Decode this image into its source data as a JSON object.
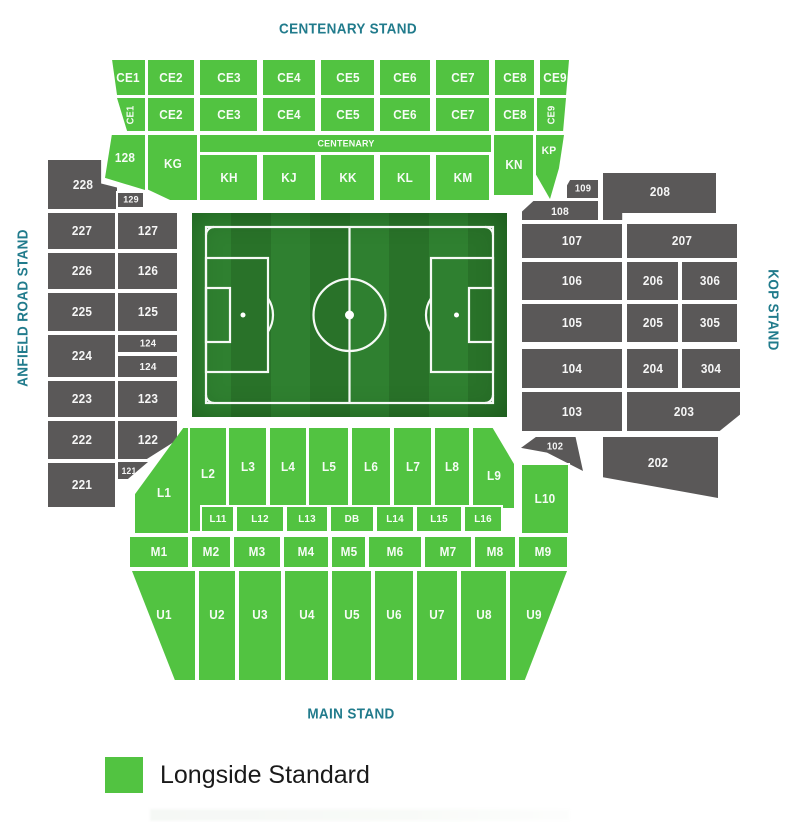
{
  "stands": {
    "centenary": "CENTENARY STAND",
    "anfield_road": "ANFIELD ROAD STAND",
    "kop": "KOP STAND",
    "main": "MAIN STAND"
  },
  "legend": {
    "items": [
      {
        "label": "Longside Standard",
        "color": "#52c341",
        "category": "available"
      }
    ]
  },
  "colors": {
    "available": "#52c341",
    "unavailable": "#5a5858",
    "title": "#217b8c",
    "legend_text": "#1a1a1a",
    "pitch_stripe_light": "#2f8030",
    "pitch_stripe_dark": "#297229",
    "pitch_line": "#ffffff"
  },
  "sections": [
    {
      "id": "ce1a",
      "label": "CE1",
      "t": "a",
      "r": [
        110,
        60,
        35,
        35
      ],
      "clip": "polygon(6% 0,100% 0,100% 100%,20% 100%)"
    },
    {
      "id": "ce2a",
      "label": "CE2",
      "t": "a",
      "r": [
        148,
        60,
        46,
        35
      ]
    },
    {
      "id": "ce3a",
      "label": "CE3",
      "t": "a",
      "r": [
        200,
        60,
        57,
        35
      ]
    },
    {
      "id": "ce4a",
      "label": "CE4",
      "t": "a",
      "r": [
        263,
        60,
        52,
        35
      ]
    },
    {
      "id": "ce5a",
      "label": "CE5",
      "t": "a",
      "r": [
        321,
        60,
        53,
        35
      ]
    },
    {
      "id": "ce6a",
      "label": "CE6",
      "t": "a",
      "r": [
        380,
        60,
        50,
        35
      ]
    },
    {
      "id": "ce7a",
      "label": "CE7",
      "t": "a",
      "r": [
        436,
        60,
        53,
        35
      ]
    },
    {
      "id": "ce8a",
      "label": "CE8",
      "t": "a",
      "r": [
        495,
        60,
        39,
        35
      ]
    },
    {
      "id": "ce9a",
      "label": "CE9",
      "t": "a",
      "r": [
        540,
        60,
        29,
        35
      ],
      "clip": "polygon(0 0,100% 0,90% 100%,0 100%)"
    },
    {
      "id": "ce1b",
      "label": "CE1",
      "t": "a",
      "r": [
        117,
        98,
        28,
        33
      ],
      "clip": "polygon(0 0,100% 0,100% 100%,36% 100%)",
      "rot": -90,
      "fs": 10
    },
    {
      "id": "ce2b",
      "label": "CE2",
      "t": "a",
      "r": [
        148,
        98,
        46,
        33
      ]
    },
    {
      "id": "ce3b",
      "label": "CE3",
      "t": "a",
      "r": [
        200,
        98,
        57,
        33
      ]
    },
    {
      "id": "ce4b",
      "label": "CE4",
      "t": "a",
      "r": [
        263,
        98,
        52,
        33
      ]
    },
    {
      "id": "ce5b",
      "label": "CE5",
      "t": "a",
      "r": [
        321,
        98,
        53,
        33
      ]
    },
    {
      "id": "ce6b",
      "label": "CE6",
      "t": "a",
      "r": [
        380,
        98,
        50,
        33
      ]
    },
    {
      "id": "ce7b",
      "label": "CE7",
      "t": "a",
      "r": [
        436,
        98,
        53,
        33
      ]
    },
    {
      "id": "ce8b",
      "label": "CE8",
      "t": "a",
      "r": [
        495,
        98,
        39,
        33
      ]
    },
    {
      "id": "ce9b",
      "label": "CE9",
      "t": "a",
      "r": [
        537,
        98,
        29,
        33
      ],
      "clip": "polygon(0 0,100% 0,90% 100%,0 100%)",
      "rot": -90,
      "fs": 10
    },
    {
      "id": "s128",
      "label": "128",
      "t": "a",
      "r": [
        105,
        135,
        40,
        55
      ],
      "clip": "polygon(17% 0,100% 0,100% 100%,0 78%)",
      "ly": 42
    },
    {
      "id": "kg",
      "label": "KG",
      "t": "a",
      "r": [
        148,
        135,
        49,
        65
      ],
      "clip": "polygon(0 0,100% 0,100% 100%,45% 100%,0 84%)",
      "ly": 45
    },
    {
      "id": "cstrip",
      "label": "CENTENARY",
      "t": "a",
      "r": [
        200,
        135,
        291,
        17
      ],
      "fs": 9.5
    },
    {
      "id": "kh",
      "label": "KH",
      "t": "a",
      "r": [
        200,
        155,
        57,
        45
      ]
    },
    {
      "id": "kj",
      "label": "KJ",
      "t": "a",
      "r": [
        263,
        155,
        52,
        45
      ]
    },
    {
      "id": "kk",
      "label": "KK",
      "t": "a",
      "r": [
        321,
        155,
        53,
        45
      ]
    },
    {
      "id": "kl",
      "label": "KL",
      "t": "a",
      "r": [
        380,
        155,
        50,
        45
      ]
    },
    {
      "id": "km",
      "label": "KM",
      "t": "a",
      "r": [
        436,
        155,
        53,
        45
      ]
    },
    {
      "id": "kn",
      "label": "KN",
      "t": "a",
      "r": [
        494,
        135,
        39,
        60
      ]
    },
    {
      "id": "kp",
      "label": "KP",
      "t": "a",
      "r": [
        536,
        135,
        28,
        64
      ],
      "clip": "polygon(0 0,100% 0,82% 52%,50% 100%,0 62%)",
      "lx": 45,
      "ly": 25,
      "fs": 11
    },
    {
      "id": "s228",
      "label": "228",
      "t": "u",
      "r": [
        48,
        160,
        69,
        49
      ],
      "clip": "polygon(0 0,77% 0,77% 48%,100% 56%,100% 100%,0 100%)"
    },
    {
      "id": "s129",
      "label": "129",
      "t": "u",
      "r": [
        118,
        193,
        25,
        14
      ],
      "fs": 9.5
    },
    {
      "id": "s227",
      "label": "227",
      "t": "u",
      "r": [
        48,
        213,
        67,
        36
      ]
    },
    {
      "id": "s127",
      "label": "127",
      "t": "u",
      "r": [
        118,
        213,
        59,
        36
      ]
    },
    {
      "id": "s226",
      "label": "226",
      "t": "u",
      "r": [
        48,
        253,
        67,
        36
      ]
    },
    {
      "id": "s126",
      "label": "126",
      "t": "u",
      "r": [
        118,
        253,
        59,
        36
      ]
    },
    {
      "id": "s225",
      "label": "225",
      "t": "u",
      "r": [
        48,
        293,
        67,
        38
      ]
    },
    {
      "id": "s125",
      "label": "125",
      "t": "u",
      "r": [
        118,
        293,
        59,
        38
      ]
    },
    {
      "id": "s124a",
      "label": "124",
      "t": "u",
      "r": [
        118,
        335,
        59,
        17
      ],
      "fs": 10
    },
    {
      "id": "s224",
      "label": "224",
      "t": "u",
      "r": [
        48,
        335,
        67,
        42
      ]
    },
    {
      "id": "s124b",
      "label": "124",
      "t": "u",
      "r": [
        118,
        356,
        59,
        21
      ],
      "fs": 10.5
    },
    {
      "id": "s223",
      "label": "223",
      "t": "u",
      "r": [
        48,
        381,
        67,
        36
      ]
    },
    {
      "id": "s123",
      "label": "123",
      "t": "u",
      "r": [
        118,
        381,
        59,
        36
      ]
    },
    {
      "id": "s222",
      "label": "222",
      "t": "u",
      "r": [
        48,
        421,
        67,
        38
      ]
    },
    {
      "id": "s122",
      "label": "122",
      "t": "u",
      "r": [
        118,
        421,
        59,
        38
      ],
      "clip": "polygon(0 0,100% 0,100% 50%,49% 100%,0 100%)"
    },
    {
      "id": "s221",
      "label": "221",
      "t": "u",
      "r": [
        48,
        463,
        67,
        44
      ]
    },
    {
      "id": "s121",
      "label": "121",
      "t": "u",
      "r": [
        118,
        462,
        30,
        17
      ],
      "clip": "polygon(0 0,100% 0,33% 100%,0 100%)",
      "fs": 9,
      "lx": 35
    },
    {
      "id": "s109",
      "label": "109",
      "t": "u",
      "r": [
        567,
        180,
        31,
        18
      ],
      "clip": "polygon(10% 0,100% 0,100% 100%,0 100%,0 30%)",
      "fs": 10
    },
    {
      "id": "s208",
      "label": "208",
      "t": "u",
      "r": [
        603,
        173,
        113,
        47
      ],
      "clip": "polygon(0 0,100% 0,100% 85%,17% 85%,17% 100%,0 100%)",
      "ly": 40
    },
    {
      "id": "s108",
      "label": "108",
      "t": "u",
      "r": [
        522,
        201,
        76,
        19
      ],
      "clip": "polygon(0 55%,15% 0,100% 0,100% 100%,0 100%)",
      "fs": 11,
      "ly": 58
    },
    {
      "id": "s107",
      "label": "107",
      "t": "u",
      "r": [
        522,
        224,
        100,
        34
      ]
    },
    {
      "id": "s207",
      "label": "207",
      "t": "u",
      "r": [
        627,
        224,
        110,
        34
      ]
    },
    {
      "id": "s106",
      "label": "106",
      "t": "u",
      "r": [
        522,
        262,
        100,
        38
      ]
    },
    {
      "id": "s206",
      "label": "206",
      "t": "u",
      "r": [
        627,
        262,
        51,
        38
      ]
    },
    {
      "id": "s306",
      "label": "306",
      "t": "u",
      "r": [
        682,
        262,
        55,
        38
      ]
    },
    {
      "id": "s105",
      "label": "105",
      "t": "u",
      "r": [
        522,
        304,
        100,
        38
      ]
    },
    {
      "id": "s205",
      "label": "205",
      "t": "u",
      "r": [
        627,
        304,
        51,
        38
      ]
    },
    {
      "id": "s305",
      "label": "305",
      "t": "u",
      "r": [
        682,
        304,
        55,
        38
      ]
    },
    {
      "id": "s104",
      "label": "104",
      "t": "u",
      "r": [
        522,
        349,
        100,
        39
      ]
    },
    {
      "id": "s204",
      "label": "204",
      "t": "u",
      "r": [
        627,
        349,
        51,
        39
      ]
    },
    {
      "id": "s304",
      "label": "304",
      "t": "u",
      "r": [
        682,
        349,
        58,
        39
      ]
    },
    {
      "id": "s103",
      "label": "103",
      "t": "u",
      "r": [
        522,
        392,
        100,
        39
      ]
    },
    {
      "id": "s203",
      "label": "203",
      "t": "u",
      "r": [
        627,
        392,
        113,
        39
      ],
      "clip": "polygon(0 0,100% 0,100% 58%,82% 100%,0 100%)"
    },
    {
      "id": "s102",
      "label": "102",
      "t": "u",
      "r": [
        521,
        437,
        62,
        34
      ],
      "clip": "polygon(0 32%,24% 0,88% 0,100% 100%,42% 46%)",
      "fs": 10,
      "lx": 55,
      "ly": 30
    },
    {
      "id": "s202",
      "label": "202",
      "t": "u",
      "r": [
        603,
        437,
        115,
        61
      ],
      "clip": "polygon(0 0,100% 0,100% 100%,0 66%)",
      "lx": 48,
      "ly": 42
    },
    {
      "id": "l1",
      "label": "L1",
      "t": "a",
      "r": [
        135,
        428,
        53,
        105
      ],
      "clip": "polygon(91% 0,100% 0,100% 100%,0 100%,0 63%)",
      "lx": 55,
      "ly": 62
    },
    {
      "id": "l2",
      "label": "L2",
      "t": "a",
      "r": [
        190,
        428,
        36,
        103
      ],
      "ly": 45
    },
    {
      "id": "l3",
      "label": "L3",
      "t": "a",
      "r": [
        229,
        428,
        37,
        78
      ]
    },
    {
      "id": "l4",
      "label": "L4",
      "t": "a",
      "r": [
        270,
        428,
        36,
        78
      ]
    },
    {
      "id": "l5",
      "label": "L5",
      "t": "a",
      "r": [
        309,
        428,
        39,
        78
      ]
    },
    {
      "id": "l6",
      "label": "L6",
      "t": "a",
      "r": [
        352,
        428,
        38,
        78
      ]
    },
    {
      "id": "l7",
      "label": "L7",
      "t": "a",
      "r": [
        394,
        428,
        37,
        78
      ]
    },
    {
      "id": "l8",
      "label": "L8",
      "t": "a",
      "r": [
        435,
        428,
        34,
        78
      ]
    },
    {
      "id": "l9",
      "label": "L9",
      "t": "a",
      "r": [
        473,
        428,
        41,
        80
      ],
      "clip": "polygon(0 0,48% 0,100% 45%,100% 100%,0 100%)",
      "ly": 60
    },
    {
      "id": "l10",
      "label": "L10",
      "t": "a",
      "r": [
        522,
        465,
        46,
        68
      ]
    },
    {
      "id": "l11",
      "label": "L11",
      "t": "a",
      "r": [
        202,
        507,
        31,
        24
      ],
      "fs": 10.5
    },
    {
      "id": "l12",
      "label": "L12",
      "t": "a",
      "r": [
        237,
        507,
        46,
        24
      ],
      "fs": 10.5
    },
    {
      "id": "l13",
      "label": "L13",
      "t": "a",
      "r": [
        287,
        507,
        40,
        24
      ],
      "fs": 10.5
    },
    {
      "id": "db",
      "label": "DB",
      "t": "a",
      "r": [
        331,
        507,
        42,
        24
      ],
      "fs": 10.5
    },
    {
      "id": "l14",
      "label": "L14",
      "t": "a",
      "r": [
        377,
        507,
        36,
        24
      ],
      "fs": 10.5
    },
    {
      "id": "l15",
      "label": "L15",
      "t": "a",
      "r": [
        417,
        507,
        44,
        24
      ],
      "fs": 10.5
    },
    {
      "id": "l16",
      "label": "L16",
      "t": "a",
      "r": [
        465,
        507,
        36,
        24
      ],
      "fs": 10.5
    },
    {
      "id": "m1",
      "label": "M1",
      "t": "a",
      "r": [
        130,
        537,
        58,
        30
      ]
    },
    {
      "id": "m2",
      "label": "M2",
      "t": "a",
      "r": [
        192,
        537,
        38,
        30
      ]
    },
    {
      "id": "m3",
      "label": "M3",
      "t": "a",
      "r": [
        234,
        537,
        46,
        30
      ]
    },
    {
      "id": "m4",
      "label": "M4",
      "t": "a",
      "r": [
        284,
        537,
        44,
        30
      ]
    },
    {
      "id": "m5",
      "label": "M5",
      "t": "a",
      "r": [
        332,
        537,
        33,
        30
      ]
    },
    {
      "id": "m6",
      "label": "M6",
      "t": "a",
      "r": [
        369,
        537,
        52,
        30
      ]
    },
    {
      "id": "m7",
      "label": "M7",
      "t": "a",
      "r": [
        425,
        537,
        46,
        30
      ]
    },
    {
      "id": "m8",
      "label": "M8",
      "t": "a",
      "r": [
        475,
        537,
        40,
        30
      ]
    },
    {
      "id": "m9",
      "label": "M9",
      "t": "a",
      "r": [
        519,
        537,
        48,
        30
      ]
    },
    {
      "id": "u1",
      "label": "U1",
      "t": "a",
      "r": [
        132,
        571,
        63,
        109
      ],
      "clip": "polygon(0 0,100% 0,100% 100%,68% 100%)",
      "ly": 40
    },
    {
      "id": "u2",
      "label": "U2",
      "t": "a",
      "r": [
        199,
        571,
        36,
        109
      ],
      "ly": 40
    },
    {
      "id": "u3",
      "label": "U3",
      "t": "a",
      "r": [
        239,
        571,
        42,
        109
      ],
      "ly": 40
    },
    {
      "id": "u4",
      "label": "U4",
      "t": "a",
      "r": [
        285,
        571,
        43,
        109
      ],
      "ly": 40
    },
    {
      "id": "u5",
      "label": "U5",
      "t": "a",
      "r": [
        332,
        571,
        39,
        109
      ],
      "ly": 40
    },
    {
      "id": "u6",
      "label": "U6",
      "t": "a",
      "r": [
        375,
        571,
        38,
        109
      ],
      "ly": 40
    },
    {
      "id": "u7",
      "label": "U7",
      "t": "a",
      "r": [
        417,
        571,
        40,
        109
      ],
      "ly": 40
    },
    {
      "id": "u8",
      "label": "U8",
      "t": "a",
      "r": [
        461,
        571,
        45,
        109
      ],
      "ly": 40
    },
    {
      "id": "u9",
      "label": "U9",
      "t": "a",
      "r": [
        510,
        571,
        57,
        109
      ],
      "clip": "polygon(0 0,100% 0,26% 100%,0 100%)",
      "lx": 42,
      "ly": 40
    }
  ]
}
